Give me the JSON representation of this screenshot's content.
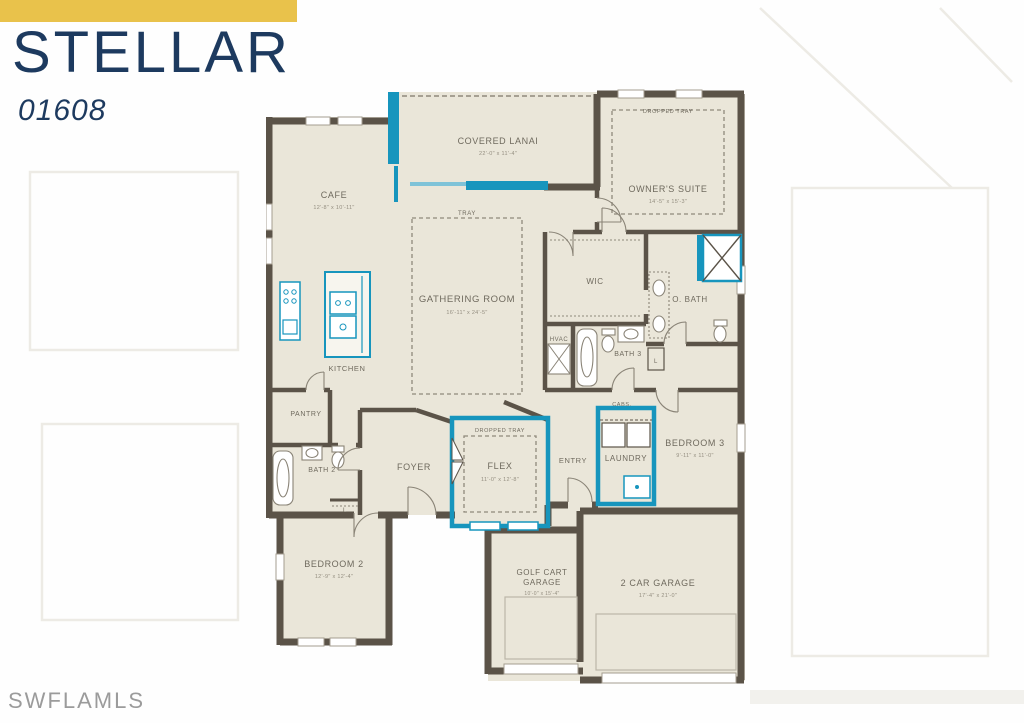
{
  "page": {
    "title": "STELLAR",
    "plan_number": "01608",
    "watermark": "SWFLAMLS"
  },
  "colors": {
    "accent_yellow": "#e9c24b",
    "title_navy": "#1d3a5f",
    "wall": "#5b5348",
    "floor": "#eae6d9",
    "highlight_teal": "#1795bd"
  },
  "rooms": {
    "covered_lanai": {
      "name": "COVERED LANAI",
      "dims": "22'-0\" x 11'-4\""
    },
    "owners_suite": {
      "name": "OWNER'S SUITE",
      "dims": "14'-5\" x 15'-3\"",
      "ceiling": "DROPPED TRAY"
    },
    "cafe": {
      "name": "CAFE",
      "dims": "12'-8\" x 10'-11\""
    },
    "gathering_room": {
      "name": "GATHERING ROOM",
      "dims": "16'-11\" x 24'-5\"",
      "ceiling": "TRAY"
    },
    "kitchen": {
      "name": "KITCHEN"
    },
    "wic": {
      "name": "WIC"
    },
    "owners_bath": {
      "name": "O. BATH"
    },
    "hvac": {
      "name": "HVAC"
    },
    "bath3": {
      "name": "BATH 3"
    },
    "pantry": {
      "name": "PANTRY"
    },
    "bath2": {
      "name": "BATH 2"
    },
    "foyer": {
      "name": "FOYER"
    },
    "flex": {
      "name": "FLEX",
      "dims": "11'-0\" x 12'-8\"",
      "ceiling": "DROPPED TRAY"
    },
    "entry": {
      "name": "ENTRY"
    },
    "laundry": {
      "name": "LAUNDRY",
      "note": "CABS."
    },
    "bedroom3": {
      "name": "BEDROOM 3",
      "dims": "9'-11\" x 11'-0\""
    },
    "bedroom2": {
      "name": "BEDROOM 2",
      "dims": "12'-9\" x 12'-4\""
    },
    "golf_cart_garage": {
      "name_line1": "GOLF CART",
      "name_line2": "GARAGE",
      "dims": "10'-0\" x 15'-4\""
    },
    "two_car_garage": {
      "name": "2 CAR GARAGE",
      "dims": "17'-4\" x 21'-0\""
    },
    "linen": {
      "abbr": "L"
    }
  }
}
